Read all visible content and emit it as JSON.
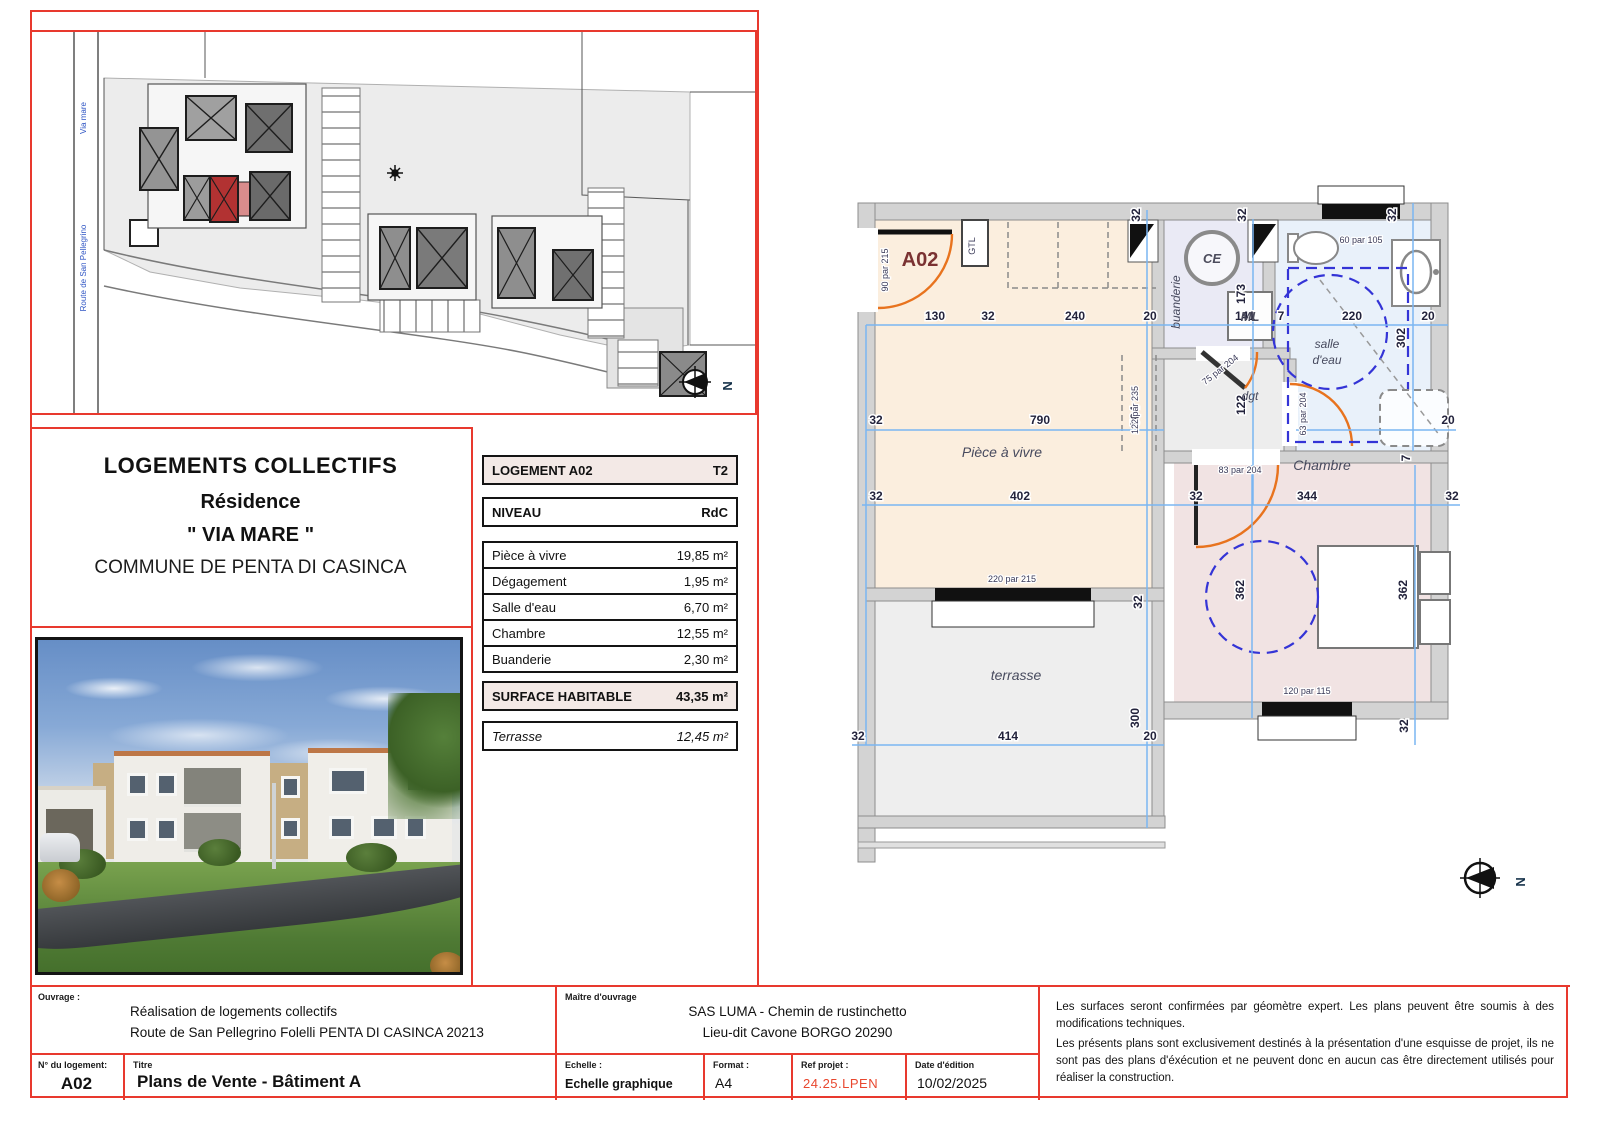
{
  "doc": {
    "project_title": [
      "LOGEMENTS COLLECTIFS",
      "Résidence",
      "\" VIA MARE \"",
      "COMMUNE DE PENTA DI CASINCA"
    ]
  },
  "unit_table": {
    "header_label": "LOGEMENT A02",
    "header_value": "T2",
    "level_label": "NIVEAU",
    "level_value": "RdC",
    "rooms": [
      {
        "label": "Pièce à vivre",
        "value": "19,85 m²"
      },
      {
        "label": "Dégagement",
        "value": "1,95 m²"
      },
      {
        "label": "Salle d'eau",
        "value": "6,70 m²"
      },
      {
        "label": "Chambre",
        "value": "12,55 m²"
      },
      {
        "label": "Buanderie",
        "value": "2,30 m²"
      }
    ],
    "total_label": "SURFACE HABITABLE",
    "total_value": "43,35 m²",
    "terrace_label": "Terrasse",
    "terrace_value": "12,45 m²"
  },
  "footer": {
    "ouvrage_label": "Ouvrage :",
    "ouvrage_line1": "Réalisation de logements collectifs",
    "ouvrage_line2": "Route de San Pellegrino Folelli PENTA DI CASINCA 20213",
    "maitre_label": "Maître d'ouvrage",
    "maitre_line1": "SAS LUMA - Chemin de rustinchetto",
    "maitre_line2": "Lieu-dit Cavone BORGO 20290",
    "unit_no_label": "N° du logement:",
    "unit_no": "A02",
    "titre_label": "Titre",
    "titre": "Plans de Vente - Bâtiment A",
    "echelle_label": "Echelle :",
    "echelle": "Echelle graphique",
    "format_label": "Format :",
    "format": "A4",
    "ref_label": "Ref projet :",
    "ref": "24.25.LPEN",
    "date_label": "Date d'édition",
    "date": "10/02/2025",
    "notes": [
      "Les surfaces seront confirmées par géomètre expert. Les plans peuvent être soumis à des modifications techniques.",
      "Les présents plans sont exclusivement destinés à la présentation d'une esquisse de projet, ils ne sont pas des plans d'éxécution et ne peuvent donc en aucun cas être directement utilisés pour réaliser la construction."
    ]
  },
  "floor_plan": {
    "unit": "A02",
    "north": "N",
    "room_labels": {
      "living": "Pièce à vivre",
      "terrace": "terrasse",
      "bedroom": "Chambre",
      "bath_line1": "salle",
      "bath_line2": "d'eau",
      "laundry": "buanderie",
      "hall": "dgt",
      "water_heater": "CE",
      "washer": "ML",
      "gtl": "GTL"
    },
    "dims": {
      "d130": "130",
      "d32": "32",
      "d240": "240",
      "d20": "20",
      "d141": "141",
      "d7": "7",
      "d220": "220",
      "d790": "790",
      "d402": "402",
      "d344": "344",
      "d414": "414",
      "d504": "504",
      "d300": "300",
      "d173": "173",
      "d122": "122",
      "d302": "302",
      "d362": "362"
    },
    "openings": {
      "entry": "90 par 215",
      "bath_window": "60 par 105",
      "hall_door": "75 par 204",
      "bath_door": "63 par 204",
      "bed_door": "83 par 204",
      "living_window": "220 par 215",
      "bed_window": "120 par 115",
      "passage": "122 par 235"
    }
  },
  "site_plan": {
    "street_1": "Via mare",
    "street_2": "Route de San Pellegrino",
    "north": "N"
  },
  "colors": {
    "accent_red": "#e8392e",
    "ref_orange": "#e8472e",
    "dim_blue": "#7ab6f2",
    "door_orange": "#e8731e",
    "subject_building_red": "#b23232"
  }
}
